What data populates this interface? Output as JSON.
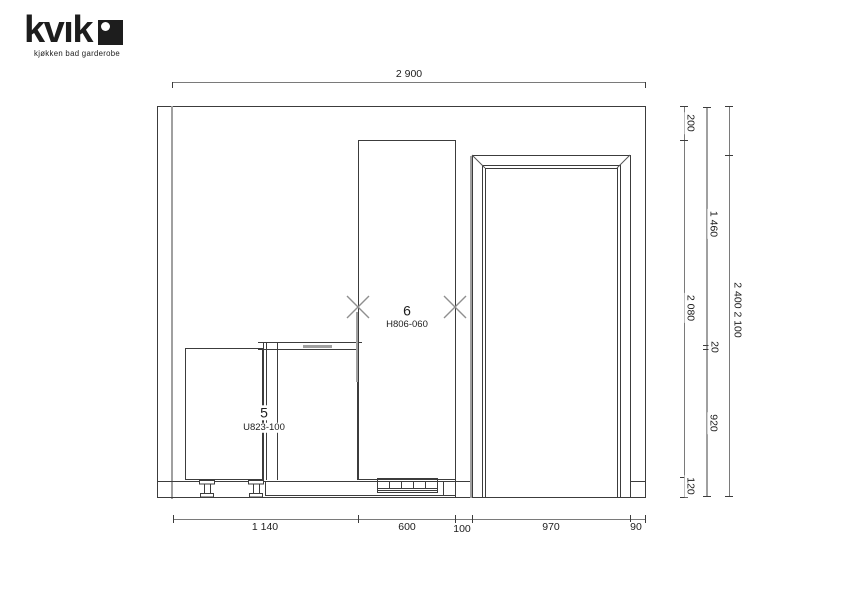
{
  "logo": {
    "brand": "kvık",
    "tagline": "kjøkken bad garderobe"
  },
  "cabinets": [
    {
      "number": "5",
      "code": "U823-100"
    },
    {
      "number": "6",
      "code": "H806-060"
    }
  ],
  "dims": {
    "top_width": "2 900",
    "bottom": {
      "seg1": "1 140",
      "seg2": "600",
      "seg3": "100",
      "seg4": "970",
      "seg5": "90"
    },
    "right_inner": {
      "top": "200",
      "middle": "2 080",
      "bottom": "120"
    },
    "right_middle": {
      "top": "1 460",
      "counter": "20",
      "bottom": "920"
    },
    "right_outer": "2 400 2 100"
  },
  "colors": {
    "line": "#3c3c3c",
    "gray_line": "#a0a0a0",
    "dim_line": "#7a7a7a"
  }
}
